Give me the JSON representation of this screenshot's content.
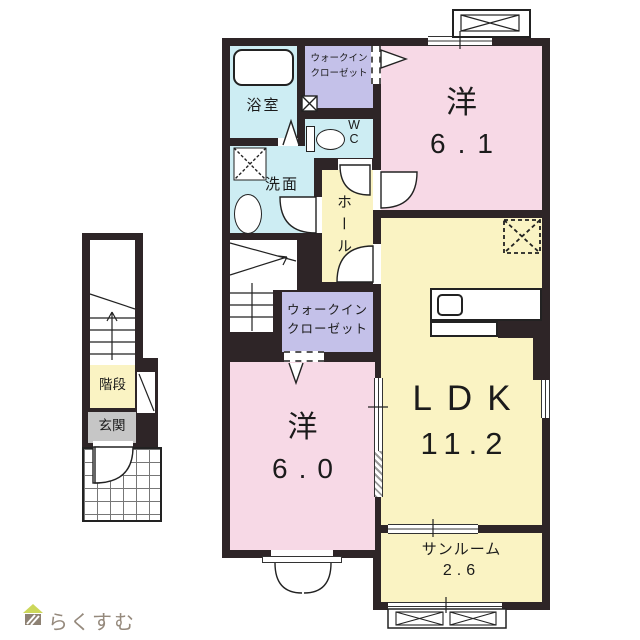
{
  "floorplan": {
    "rooms": {
      "bath": {
        "label": "浴室"
      },
      "washroom": {
        "label": "洗面"
      },
      "wc": {
        "line1": "W",
        "line2": "C"
      },
      "hall": {
        "label": "ホール"
      },
      "wic_upper": {
        "line1": "ウォークイン",
        "line2": "クローゼット"
      },
      "wic_lower": {
        "line1": "ウォークイン",
        "line2": "クローゼット"
      },
      "western_61": {
        "label": "洋",
        "size": "6.1"
      },
      "western_60": {
        "label": "洋",
        "size": "6.0"
      },
      "ldk": {
        "label": "LDK",
        "size": "11.2"
      },
      "sunroom": {
        "label": "サンルーム",
        "size": "2.6"
      },
      "stairs": {
        "label": "階段"
      },
      "entrance": {
        "label": "玄関"
      }
    },
    "logo": {
      "text": "らくすむ"
    },
    "colors": {
      "wall": "#2e2527",
      "room-pink": "#f7d9e6",
      "room-yellow": "#faf3c3",
      "room-blue": "#cdedf3",
      "room-purple": "#c4c1e9",
      "room-gray": "#c6c6c6",
      "logo-text": "#95897c",
      "logo-roof": "#ccd75a",
      "logo-body": "#8d8173"
    }
  }
}
